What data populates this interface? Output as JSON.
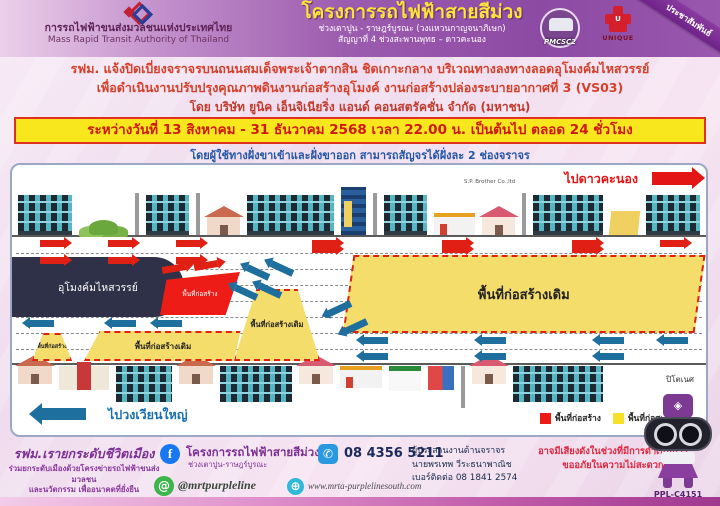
{
  "header": {
    "agency_th": "การรถไฟฟ้าขนส่งมวลชนแห่งประเทศไทย",
    "agency_en": "Mass Rapid Transit Authority of Thailand",
    "title": "โครงการรถไฟฟ้าสายสีม่วง",
    "subtitle1": "ช่วงเตาปูน - ราษฎร์บูรณะ (วงแหวนกาญจนาภิเษก)",
    "subtitle2": "สัญญาที่ 4 ช่วงสะพานพุทธ – ดาวคะนอง",
    "logo_pmcsc": "PMCSC2",
    "logo_unique": "UNIQUE",
    "logo_unique_letter": "U",
    "ribbon": "ประชาสัมพันธ์"
  },
  "announcement": {
    "line1": "รฟม. แจ้งปิดเบี่ยงจราจรบนถนนสมเด็จพระเจ้าตากสิน ชิดเกาะกลาง บริเวณทางลงทางลอดอุโมงค์มไหสวรรย์",
    "line2": "เพื่อดำเนินงานปรับปรุงคุณภาพดินงานก่อสร้างอุโมงค์ งานก่อสร้างปล่องระบายอากาศที่ 3 (VS03)",
    "line3": "โดย บริษัท ยูนิค เอ็นจิเนียริ่ง แอนด์ คอนสตรัคชั่น จำกัด (มหาชน)",
    "period": "ระหว่างวันที่ 13 สิงหาคม - 31 ธันวาคม 2568 เวลา 22.00 น. เป็นต้นไป ตลอด 24 ชั่วโมง",
    "note": "โดยผู้ใช้ทางฝั่งขาเข้าและฝั่งขาออก สามารถสัญจรได้ฝั่งละ 2 ช่องจราจร"
  },
  "map": {
    "direction_right": "ไปดาวคะนอง",
    "direction_left": "ไปวงเวียนใหญ่",
    "tunnel": "อุโมงค์มไหสวรรย์",
    "closure_area": "พื้นที่ก่อสร้าง",
    "existing_area": "พื้นที่ก่อสร้างเดิม",
    "building_label": "S.P. Brother Co.,ltd",
    "place_right": "ปิโตเนศ",
    "legend": [
      {
        "label": "พื้นที่ก่อสร้าง",
        "color": "#ed1c16"
      },
      {
        "label": "พื้นที่ก่อสร้างเดิม",
        "color": "#f6e02a"
      }
    ]
  },
  "footer": {
    "tagline": "รฟม.เรายกระดับชีวิตเมือง",
    "tagline_sub1": "ร่วมยกระดับเมืองด้วยโครงข่ายรถไฟฟ้าขนส่งมวลชน",
    "tagline_sub2": "และนวัตกรรม เพื่ออนาคตที่ยั่งยืน",
    "facebook_name": "โครงการรถไฟฟ้าสายสีม่วง",
    "facebook_sub": "ช่วงเตาปูน-ราษฎร์บูรณะ",
    "phone": "08 4356 5211",
    "instagram": "@mrtpurpleline",
    "website": "www.mrta-purplelinesouth.com",
    "coordinator_title": "ผู้ประสานงานด้านจราจร",
    "coordinator_name": "นายพรเทพ วีระธนาพาณิช",
    "coordinator_phone": "เบอร์ติดต่อ 08 1841 2574",
    "warning1": "อาจมีเสียงดังในช่วงที่มีการดำเนินการ",
    "warning2": "ขออภัยในความไม่สะดวก",
    "mascot_code": "PPL-C4151"
  },
  "colors": {
    "header_purple": "#8d4aa4",
    "banner_yellow": "#f8e71c",
    "announcement_red": "#d6402a",
    "note_blue": "#2456a8",
    "zone_red": "#ed1c16",
    "zone_yellow": "#f4dd6a",
    "tunnel_navy": "#2e3148"
  }
}
